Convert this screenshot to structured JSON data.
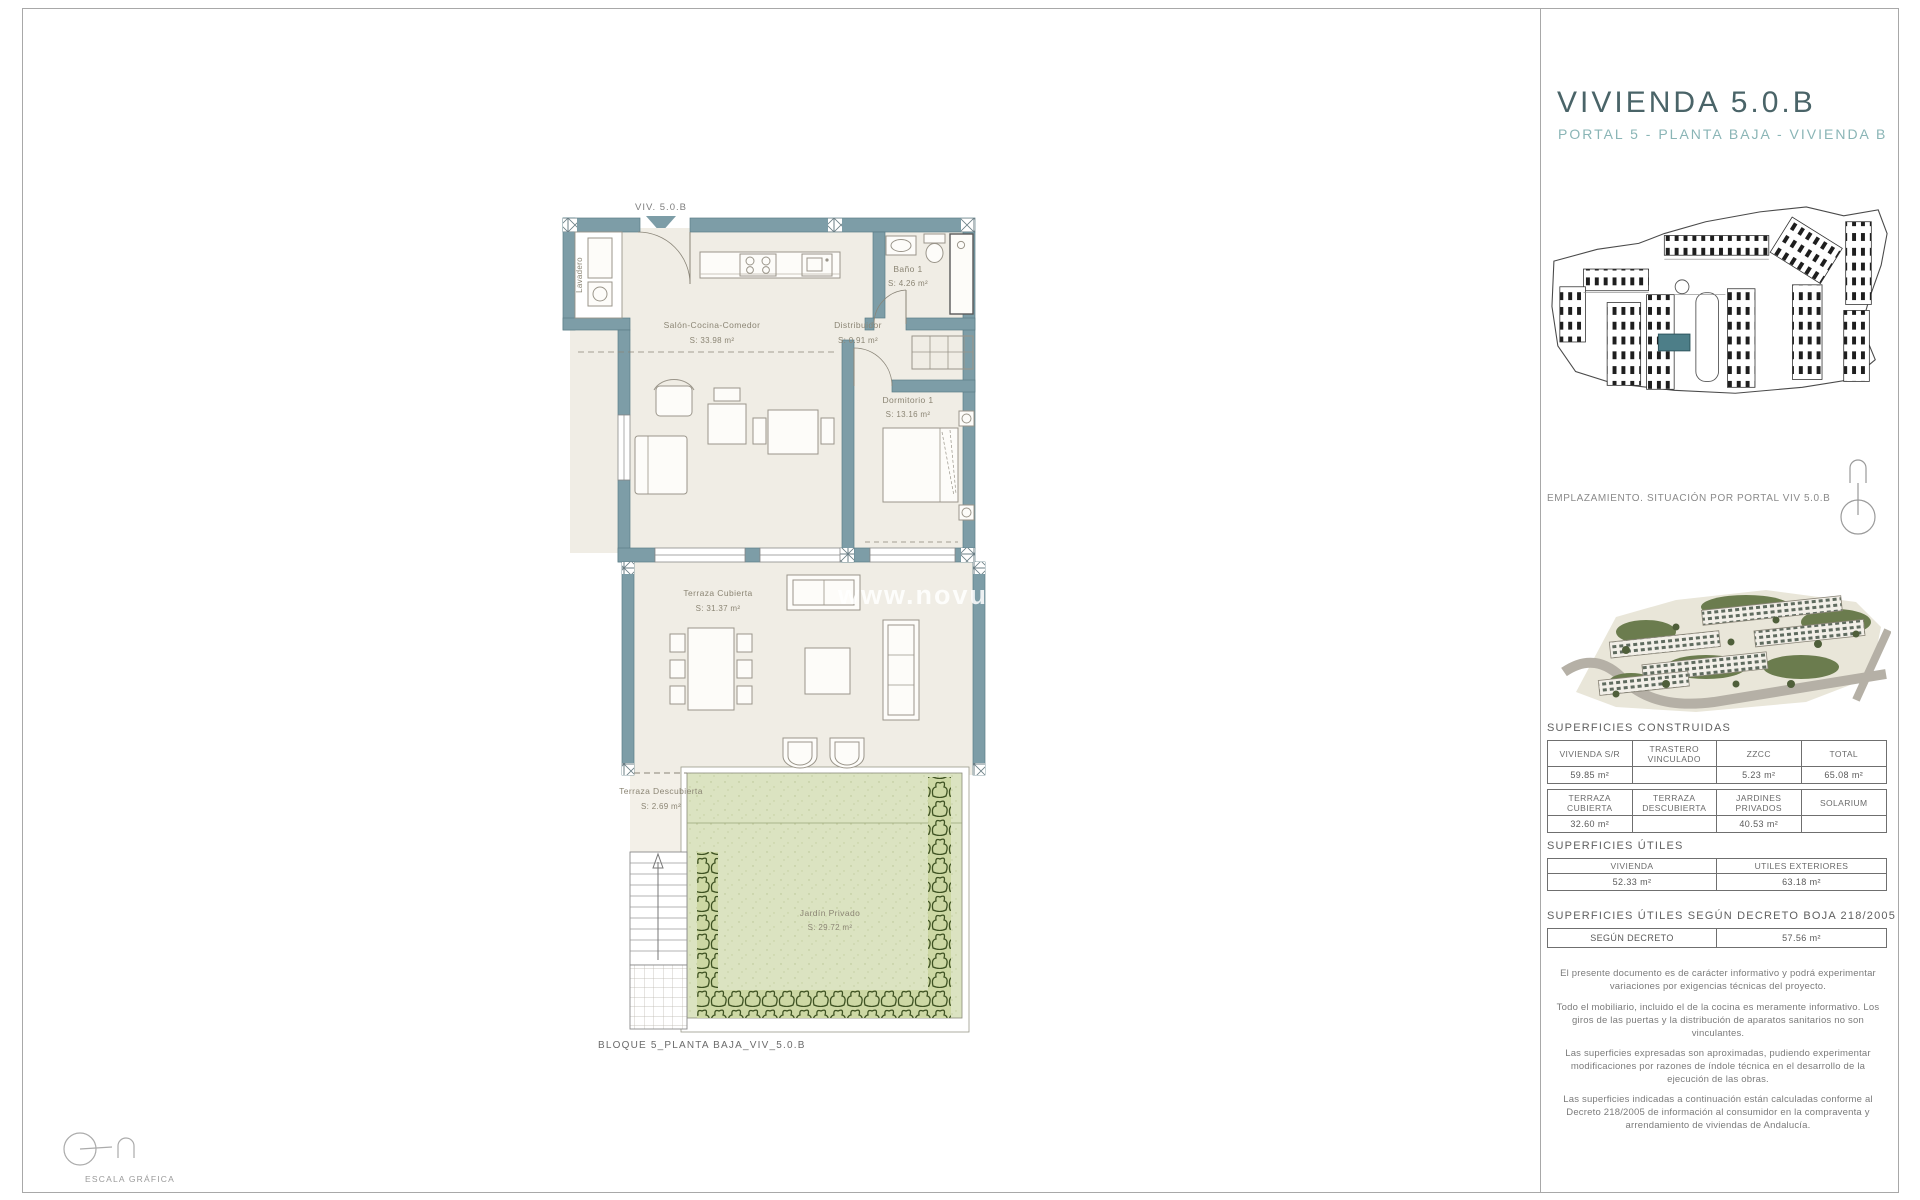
{
  "panel": {
    "title": "VIVIENDA 5.0.B",
    "subtitle": "PORTAL 5 - PLANTA BAJA - VIVIENDA B",
    "emplazamiento": "EMPLAZAMIENTO. SITUACIÓN POR PORTAL VIV 5.0.B",
    "construidas": {
      "heading": "SUPERFICIES CONSTRUIDAS",
      "t1": {
        "h": [
          "VIVIENDA S/R",
          "TRASTERO VINCULADO",
          "ZZCC",
          "TOTAL"
        ],
        "v": [
          "59.85 m²",
          "",
          "5.23 m²",
          "65.08 m²"
        ]
      },
      "t2": {
        "h": [
          "TERRAZA CUBIERTA",
          "TERRAZA DESCUBIERTA",
          "JARDINES PRIVADOS",
          "SOLARIUM"
        ],
        "v": [
          "32.60 m²",
          "",
          "40.53 m²",
          ""
        ]
      }
    },
    "utiles": {
      "heading": "SUPERFICIES ÚTILES",
      "h": [
        "VIVIENDA",
        "UTILES EXTERIORES"
      ],
      "v": [
        "52.33 m²",
        "63.18 m²"
      ]
    },
    "decreto": {
      "heading": "SUPERFICIES ÚTILES SEGÚN DECRETO BOJA 218/2005",
      "label": "SEGÚN DECRETO",
      "value": "57.56 m²"
    },
    "legal": [
      "El presente documento es de carácter informativo y podrá experimentar variaciones por exigencias técnicas del proyecto.",
      "Todo el mobiliario, incluido el de la cocina es meramente informativo. Los giros de las puertas y la distribución de aparatos sanitarios no son vinculantes.",
      "Las superficies expresadas son aproximadas, pudiendo experimentar modificaciones por razones de índole técnica en el desarrollo de la ejecución de las obras.",
      "Las superficies indicadas a continuación están calculadas conforme al Decreto 218/2005 de información al consumidor en la compraventa y arrendamiento de viviendas de Andalucía."
    ]
  },
  "plan": {
    "unit_label": "VIV. 5.0.B",
    "caption": "BLOQUE 5_PLANTA BAJA_VIV_5.0.B",
    "scale_label": "ESCALA GRÁFICA",
    "watermark": "www.novus",
    "rooms": {
      "salon": {
        "name": "Salón-Cocina-Comedor",
        "area": "S: 33.98 m²"
      },
      "distribuidor": {
        "name": "Distribuidor",
        "area": "S: 0.91 m²"
      },
      "bano": {
        "name": "Baño 1",
        "area": "S: 4.26 m²"
      },
      "dormitorio": {
        "name": "Dormitorio 1",
        "area": "S: 13.16 m²"
      },
      "terraza_cubierta": {
        "name": "Terraza Cubierta",
        "area": "S: 31.37 m²"
      },
      "terraza_descubierta": {
        "name": "Terraza Descubierta",
        "area": "S: 2.69 m²"
      },
      "jardin": {
        "name": "Jardín Privado",
        "area": "S: 29.72 m²"
      },
      "lavadero": {
        "name": "Lavadero"
      }
    }
  },
  "colors": {
    "wall_teal": "#7d9da7",
    "floor_beige": "#f0ede5",
    "garden_green": "#dbe3c1",
    "hedge_green": "#3e5222",
    "title_dark_teal": "#4a6468",
    "subtitle_teal": "#8ab5b6",
    "site_highlight": "#4d7e88"
  }
}
